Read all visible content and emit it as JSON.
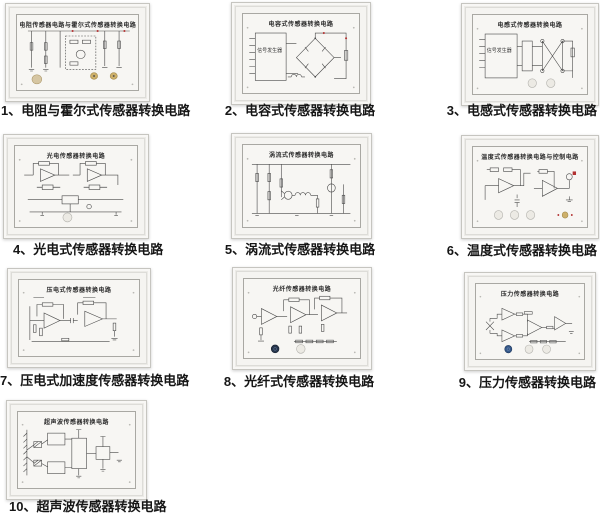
{
  "page": {
    "background": "#ffffff",
    "description": "传感器转换电路挂板一览"
  },
  "palette": {
    "panel_frame": "#ecebe7",
    "panel_face": "#f5f4f1",
    "inner_border": "#a9a8a3",
    "schematic_line": "#4a4a4a",
    "caption_color": "#161616",
    "knob_white": "#eceae4",
    "knob_beige": "#d6c6a2",
    "knob_blue": "#35588a",
    "knob_dark": "#27364d",
    "terminal_gold": "#cdb06a",
    "red_dot": "#b23131"
  },
  "panels": [
    {
      "id": "1",
      "title": "电阻传感器电路与霍尔式传感器转换电路",
      "caption": "1、电阻与霍尔式传感器转换电路"
    },
    {
      "id": "2",
      "title": "电容式传感器转换电路",
      "caption": "2、电容式传感器转换电路",
      "box_label": "信号发生器"
    },
    {
      "id": "3",
      "title": "电感式传感器转换电路",
      "caption": "3、电感式传感器转换电路",
      "box_label": "信号发生器"
    },
    {
      "id": "4",
      "title": "光电传感器转换电路",
      "caption": "4、光电式传感器转换电路"
    },
    {
      "id": "5",
      "title": "涡流式传感器转换电路",
      "caption": "5、涡流式传感器转换电路"
    },
    {
      "id": "6",
      "title": "温度式传感器转换电路与控制电路",
      "caption": "6、温度式传感器转换电路"
    },
    {
      "id": "7",
      "title": "压电式传感器转换电路",
      "caption": "7、压电式加速度传感器转换电路"
    },
    {
      "id": "8",
      "title": "光纤传感器转换电路",
      "caption": "8、光纤式传感器转换电路"
    },
    {
      "id": "9",
      "title": "压力传感器转换电路",
      "caption": "9、压力传感器转换电路"
    },
    {
      "id": "10",
      "title": "超声波传感器转换电路",
      "caption": "10、超声波传感器转换电路"
    }
  ]
}
